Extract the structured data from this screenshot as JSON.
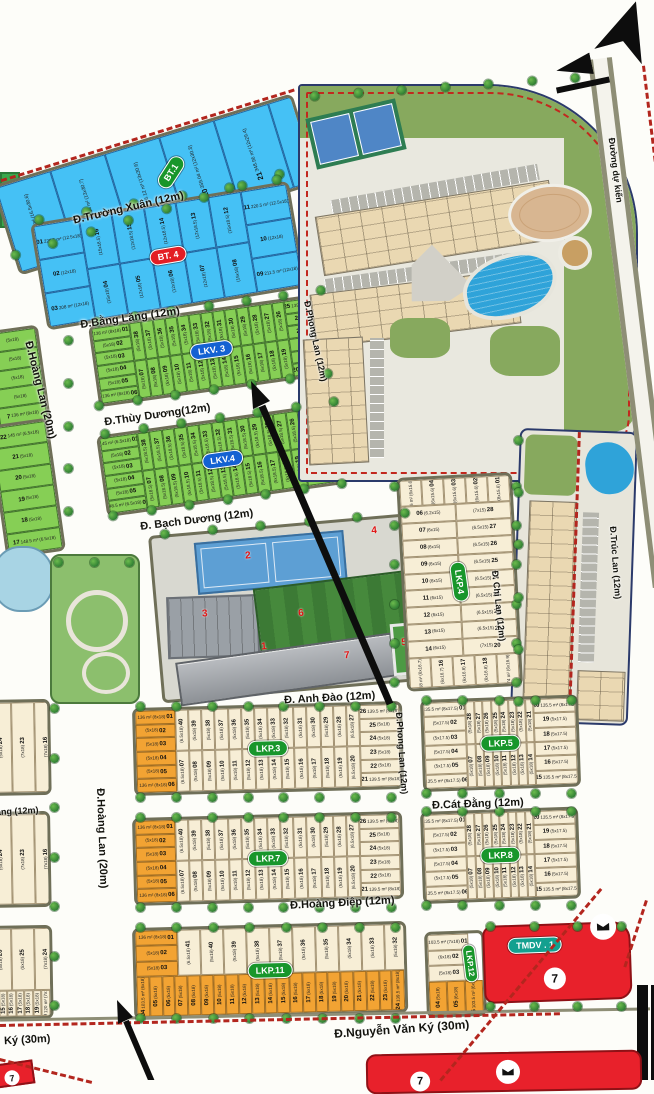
{
  "streets": {
    "truong_xuan": "Đ.Trường Xuân (12m)",
    "bang_lang": "Đ.Bằng Lăng (12m)",
    "hoang_lan": "Đ.Hoàng Lan (20m)",
    "thuy_duong": "Đ.Thùy Dương(12m)",
    "bach_duong": "Đ. Bạch Dương (12m)",
    "phong_lan": "Đ.Phong Lan (12m)",
    "anh_dao": "Đ. Anh Đào (12m)",
    "chi_lan": "Đ. Chi Lan (12m)",
    "truc_lan": "Đ.Trúc Lan (12m)",
    "cat_dang": "Đ.Cát Đằng (12m)",
    "hoang_diep": "Đ.Hoàng Điệp (12m)",
    "nguyen_van_ky": "Đ.Nguyễn Văn Ký (30m)",
    "ky_fragment": "Ký (30m)",
    "ang_fragment": "ăng (12m)",
    "du_kien": "Đường dự kiến"
  },
  "misc": {
    "badge7": "7"
  },
  "school": {
    "numbers": [
      "1",
      "2",
      "3",
      "4",
      "5",
      "6",
      "7"
    ]
  },
  "blocks": {
    "bt1": {
      "label": "BT.1",
      "lots": [
        "17|510.51 m²|(16.5x30.6)",
        "18|368.34 m²|(13x30.7)",
        "19|366.12 m²|(13x30.6)",
        "20|359.04 m²|(12x30.3)",
        "21|348.96 m²|(12x29.4)",
        "22|341.34 m²|(12x28.8)",
        "23|341.34 m²|(12x28.2)",
        "24|330.18 m²|(12x27.3)",
        "25|446.33 m²|(16.5x27.2)"
      ]
    },
    "bt4": {
      "label": "BT. 4",
      "left": [
        "01|220.5 m²|(12.5x18)",
        "02||(12x18)",
        "03|208 m²|(12x18)"
      ],
      "top": [
        "16||(15x18.5)",
        "15||(12x18.5)",
        "14||(12x18.5)",
        "13||(12x18.5)",
        "12||(15x18.5)"
      ],
      "bottom": [
        "04||(15x18)",
        "05||(12x18)",
        "06||(12x18)",
        "07||(12x18)",
        "08||(15x18)"
      ],
      "right": [
        "11|220.5 m²|(12.5x18)",
        "10||(12x18)",
        "09|211.5 m²|(12x18)"
      ]
    },
    "lkv3": {
      "label": "LKV. 3",
      "left": [
        "01|136 m²|(8x18)",
        "02||(5x18)",
        "03||(5x18)",
        "04||(5x18)",
        "05||(5x18)",
        "06|136 m²|(8x18)"
      ],
      "top": [
        "38||(5x18)",
        "37||(5x18)",
        "36||(5x18)",
        "35||(5x18)",
        "34||(5x18)",
        "33||(5x18)",
        "32||(5x18)",
        "31||(5x18)",
        "30||(5x18)",
        "29||(5x18)",
        "28||(5x18)",
        "27||(5x18)",
        "26||(5x18)"
      ],
      "bottom": [
        "07||(5x18)",
        "08||(5x18)",
        "09||(5x18)",
        "10||(5x18)",
        "11||(5x18)",
        "12||(5x18)",
        "13||(5x18)",
        "14||(5x18)",
        "15||(5x18)",
        "16||(5x18)",
        "17||(5x18)",
        "18||(5x18)",
        "19||(5x18)"
      ],
      "right": [
        "25|139.5 m²|(8x18)",
        "24||(5x18)",
        "23||(5x18)",
        "22||(5x18)",
        "21||(5x18)",
        "20|139.5 m²|(8x18)"
      ]
    },
    "lkv4": {
      "label": "LKV.4",
      "left": [
        "01|145 m²|(6.5x18)",
        "02||(5x18)",
        "03||(5x18)",
        "04||(5x18)",
        "05||(5x18)",
        "06|148.5 m²|(6.5x18)"
      ],
      "top": [
        "38||(5x18.5)",
        "37||(5x18.5)",
        "36||(5x18.5)",
        "35||(5x18.5)",
        "34||(5x18.5)",
        "33||(5x18.5)",
        "32||(5x18.5)",
        "31||(5x18.5)",
        "30||(5x18.5)",
        "29||(5x18.5)",
        "28||(5x18.5)",
        "27||(5x18.5)",
        "26||(5x18.5)"
      ],
      "bottom": [
        "07||(5x18.5)",
        "08||(5x18.5)",
        "09||(5x18.5)",
        "10||(5x18.5)",
        "11||(5x18.5)",
        "12||(5x18.5)",
        "13||(5x18.5)",
        "14||(5x18.5)",
        "15||(5x18.5)",
        "16||(5x18.5)",
        "17||(5x18.5)",
        "18||(5x18.5)",
        "19||(5x18.5)"
      ],
      "right": [
        "25|148.5 m²|(8.5x18)",
        "24||(5x18)",
        "23||(5x18)",
        "22||(5x18)",
        "21||(5x18)",
        "20|148.5 m²|(8.5x18)"
      ]
    },
    "lkp3": {
      "label": "LKP.3",
      "left": [
        "01|136 m²|(8x18)",
        "02||(5x18)",
        "03||(5x18)",
        "04||(5x18)",
        "05||(5x18)",
        "06|136 m²|(8x18)"
      ],
      "top": [
        "40||(6.5x18)",
        "39||(5x18)",
        "38||(5x18)",
        "37||(5x18)",
        "36||(5x18)",
        "35||(5x18)",
        "34||(5x18)",
        "33||(5x18)",
        "32||(5x18)",
        "31||(5x18)",
        "30||(5x18)",
        "29||(5x18)",
        "28||(5x18)",
        "27||(6.5x18)"
      ],
      "bottom": [
        "07||(6.5x18)",
        "08||(5x18)",
        "09||(5x18)",
        "10||(5x18)",
        "11||(5x18)",
        "12||(5x18)",
        "13||(5x18)",
        "14||(5x18)",
        "15||(5x18)",
        "16||(5x18)",
        "17||(5x18)",
        "18||(5x18)",
        "19||(5x18)",
        "20||(6.5x18)"
      ],
      "right": [
        "26|139.5 m²|(8x18)",
        "25||(5x18)",
        "24||(5x18)",
        "23||(5x18)",
        "22||(5x18)",
        "21|139.5 m²|(8x18)"
      ]
    },
    "lkp4": {
      "label": "LKP.4",
      "top": [
        "05|95.16 m²|(6x15.6)",
        "04||(6x15.6)",
        "03||(6x15.6)",
        "02||(6x15.6)",
        "01||(8x15.6)"
      ],
      "left": [
        "06||(6.2x15)",
        "07||(6x15)",
        "08||(6x15)",
        "09||(6x15)",
        "10||(6x15)",
        "11||(6x15)",
        "12||(6x15)",
        "13||(6x15)",
        "14||(6x15)"
      ],
      "right": [
        "28||(7x15)",
        "27||(6.5x15)",
        "26||(6.5x15)",
        "25||(6.5x15)",
        "24||(6.5x15)",
        "23||(6.5x15)",
        "22||(6.5x15)",
        "21||(6.5x15)",
        "20||(7x15)"
      ],
      "bottom": [
        "15|97.18 m²|(6x16.7)",
        "16||(6x16.7)",
        "17||(6x16.8)",
        "18||(6x16.8)",
        "19|92.74 m²|(6x16.9)"
      ]
    },
    "lkp5": {
      "label": "LKP.5",
      "left": [
        "01|135.5 m²|(8x17.5)",
        "02||(5x17.5)",
        "03||(5x17.5)",
        "04||(5x17.5)",
        "05||(5x17.5)",
        "06|135.5 m²|(8x17.5)"
      ],
      "top": [
        "28||(5x18)",
        "27||(5x18)",
        "26||(5x18)",
        "25||(5x18)",
        "24||(5x18)",
        "23||(5x18)",
        "22||(5x18)",
        "21||(5x18)"
      ],
      "bottom": [
        "07||(5x18)",
        "08||(5x18)",
        "09||(5x18)",
        "10||(5x18)",
        "11||(5x18)",
        "12||(5x18)",
        "13||(5x18)",
        "14||(5x18)"
      ],
      "right": [
        "20|135.5 m²|(8x17.5)",
        "19||(5x17.5)",
        "18||(5x17.5)",
        "17||(5x17.5)",
        "16||(5x17.5)",
        "15|135.5 m²|(8x17.5)"
      ]
    },
    "lkp7": {
      "label": "LKP.7",
      "left": [
        "01|136 m²|(8x18)",
        "02||(5x18)",
        "03||(5x18)",
        "04||(5x18)",
        "05||(5x18)",
        "06|136 m²|(8x18)"
      ],
      "top": [
        "40||(6.5x18)",
        "39||(5x18)",
        "38||(5x18)",
        "37||(5x18)",
        "36||(5x18)",
        "35||(5x18)",
        "34||(5x18)",
        "33||(5x18)",
        "32||(5x18)",
        "31||(5x18)",
        "30||(5x18)",
        "29||(5x18)",
        "28||(5x18)",
        "27||(6.5x18)"
      ],
      "bottom": [
        "07||(6.5x18)",
        "08||(5x18)",
        "09||(5x18)",
        "10||(5x18)",
        "11||(5x18)",
        "12||(5x18)",
        "13||(5x18)",
        "14||(5x18)",
        "15||(5x18)",
        "16||(5x18)",
        "17||(5x18)",
        "18||(5x18)",
        "19||(5x18)",
        "20||(6.5x18)"
      ],
      "right": [
        "26|139.5 m²|(8x18)",
        "25||(5x18)",
        "24||(5x18)",
        "23||(5x18)",
        "22||(5x18)",
        "21|139.5 m²|(8x18)"
      ]
    },
    "lkp8": {
      "label": "LKP.8",
      "left": [
        "01|135.5 m²|(8x17.5)",
        "02||(5x17.5)",
        "03||(5x17.5)",
        "04||(5x17.5)",
        "05||(5x17.5)",
        "06|135.5 m²|(8x17.5)"
      ],
      "top": [
        "28||(5x18)",
        "27||(5x18)",
        "26||(5x18)",
        "25||(5x18)",
        "24||(5x18)",
        "23||(5x18)",
        "22||(5x18)",
        "21||(5x18)"
      ],
      "bottom": [
        "07||(5x18)",
        "08||(5x18)",
        "09||(5x18)",
        "10||(5x18)",
        "11||(5x18)",
        "12||(5x18)",
        "13||(5x18)",
        "14||(5x18)"
      ],
      "right": [
        "20|135.5 m²|(8x17.5)",
        "19||(5x17.5)",
        "18||(5x17.5)",
        "17||(5x17.5)",
        "16||(5x17.5)",
        "15|135.5 m²|(8x17.5)"
      ]
    },
    "lkp11": {
      "label": "LKP.11",
      "left": [
        "01|136 m²|(8x18)",
        "02||(5x18)",
        "03||(5x18)"
      ],
      "top": [
        "41||(6.5x18)",
        "40||(5x18)",
        "39||(5x18)",
        "38||(5x18)",
        "37||(5x18)",
        "36||(5x18)",
        "35||(5x18)",
        "34||(5x18)",
        "33||(5x18)",
        "32||(5x18)",
        "31||(5x18)",
        "30||(5x18)",
        "29||(5x18)",
        "28||(6.5x18)"
      ],
      "right": [
        "27|139.5 m²|(8x18)",
        "26||(5x18)",
        "25||(5x18)"
      ],
      "bottom": [
        "04|103.5 m²|(6x18)",
        "05||(5x18)",
        "06||(5x18)",
        "07||(5x18)",
        "08||(5x18)",
        "09||(5x18)",
        "10||(5x18)",
        "11||(5x18)",
        "12||(5x18)",
        "13||(5x18)",
        "14||(5x18)",
        "15||(5x18)",
        "16||(5x18)",
        "17||(5x18)",
        "18||(5x18)",
        "19||(5x18)",
        "20||(5x18)",
        "21||(5x18)",
        "22||(5x18)",
        "23||(5x18)",
        "24|139.5 m²|(8x18)"
      ]
    },
    "lkp12": {
      "label": "LKP.12",
      "left": [
        "01|103.5 m²|(7x18)",
        "02||(6x18)",
        "03||(5x18)"
      ],
      "bottom": [
        "04||(5x18)",
        "05||(6x18)",
        "06|103.5 m²|(6x18)"
      ]
    },
    "tmdv1": {
      "label": "TMDV . 1"
    },
    "westA": {
      "col": [
        "||(5x18)",
        "||(5x18)",
        "||(5x18)",
        "||(5x18)",
        "7|136 m²|(8x18)"
      ]
    },
    "westB": {
      "col": [
        "22|145 m²|(6.5x18)",
        "21||(5x18)",
        "20||(5x18)",
        "19||(5x18)",
        "18||(5x18)",
        "17|148.5 m²|(6.5x18)"
      ]
    },
    "westC": {
      "part": [
        "24||(5x18)",
        "23||(7x18)"
      ],
      "inner": [
        "16||(7x18)",
        "15||(5x18)",
        "14||(5x18)"
      ],
      "col": [
        "22|136 m²|(8x18)",
        "21||(5x18)",
        "20||(5x18)",
        "19||(5x18)",
        "18||(5x18)",
        "17|136 m²|(8x18)"
      ]
    },
    "westD": {
      "part": [
        "24||(5x18)",
        "23||(7x18)"
      ],
      "inner": [
        "16||(7x18)",
        "15||(5x18)",
        "14||(5x18)"
      ],
      "col": [
        "22|136 m²|(8x18)",
        "21||(5x18)",
        "20||(5x18)",
        "19||(5x18)",
        "18||(5x18)",
        "17|136 m²|(8x18)"
      ]
    },
    "westE": {
      "part": [
        "26||(5x18)",
        "25||(5x18)",
        "24||(7x18)"
      ],
      "col": [
        "23|136 m²|(8x18)",
        "22||(5x18)",
        "21||(5x18)"
      ],
      "bottom": [
        "14||(5x18)",
        "15||(5x18)",
        "16||(5x18)",
        "17||(5x18)",
        "18||(5x18)",
        "19||(5x18)",
        "20|120 m²|(7x18)"
      ]
    }
  }
}
